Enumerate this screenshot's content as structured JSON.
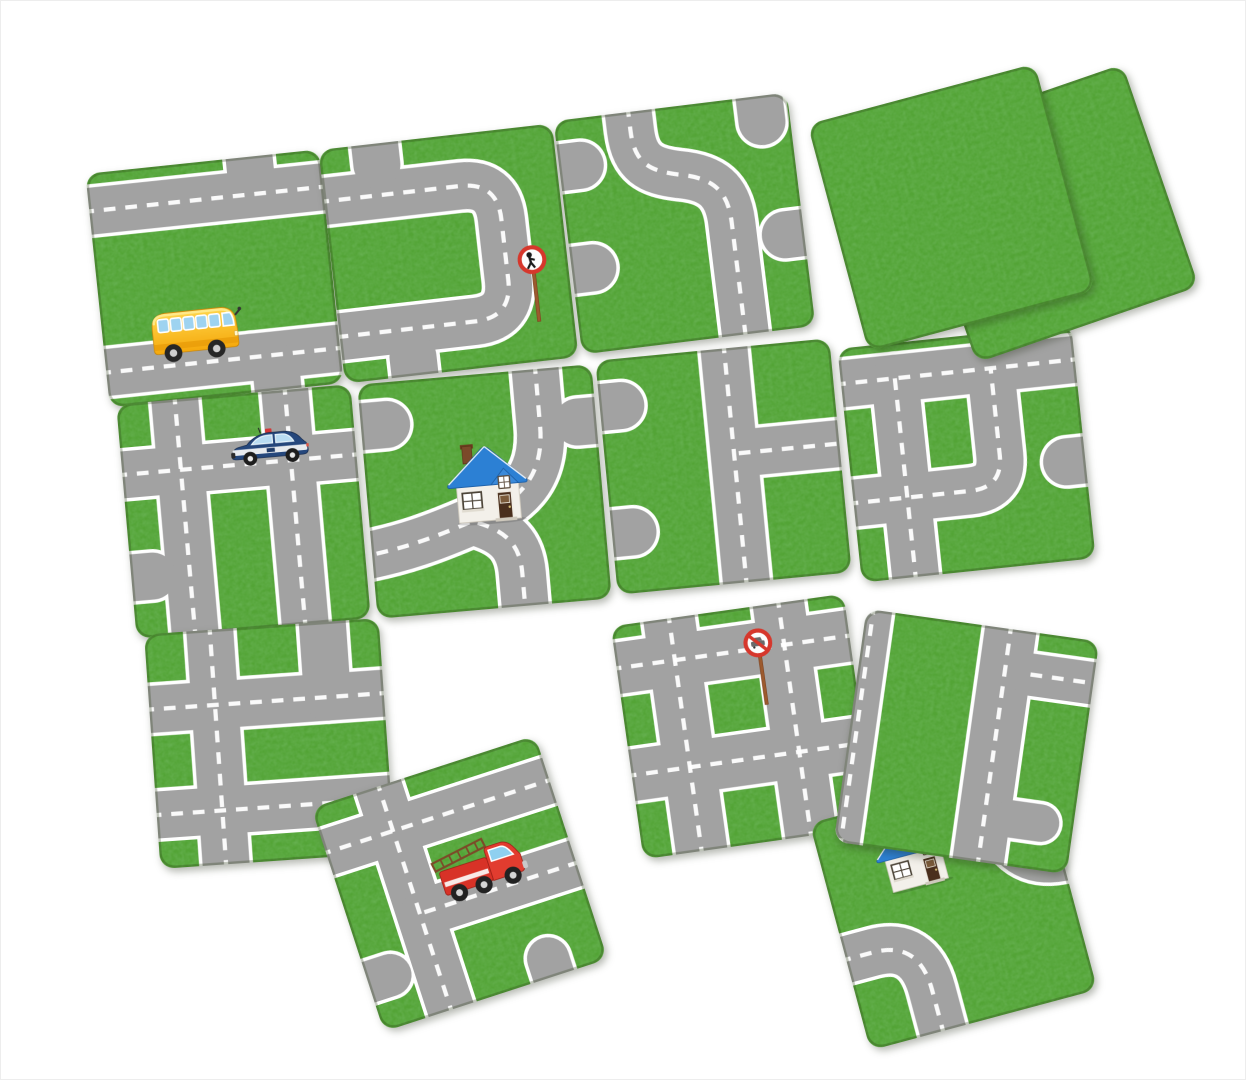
{
  "scene": {
    "width": 1246,
    "height": 1080,
    "background": "#ffffff",
    "description": "road tile matching game pieces laid out on white surface"
  },
  "palette": {
    "grass": "#53a436",
    "grass_dark": "#2e7d1e",
    "road": "#a2a2a2",
    "road_edge": "#ffffff",
    "dash": "#ffffff",
    "tile_border": "rgba(35,55,15,0.28)",
    "sign_red": "#d6372c",
    "pole_brown": "#9c5a2e",
    "bus_yellow": "#f5a90c",
    "truck_red": "#d83227",
    "police_navy": "#25477c",
    "roof_blue": "#2c80d4"
  },
  "tiles": [
    {
      "id": "t1",
      "name": "road-tile-bus",
      "cx": 213,
      "cy": 277,
      "size": 235,
      "rot": -6,
      "z": 1,
      "roads": [
        {
          "d": "M-3,16 H103",
          "w": 20,
          "dash": true
        },
        {
          "d": "M-3,85 H103",
          "w": 20,
          "dash": true
        },
        {
          "d": "M62,85 Q72,85 72,95 V103",
          "w": 20,
          "dash": false
        },
        {
          "d": "M70,-3 V9",
          "w": 20,
          "dash": false
        }
      ],
      "sprites": [
        {
          "icon": "school-bus",
          "x": 18,
          "y": 56,
          "w": 42,
          "h": 29
        }
      ]
    },
    {
      "id": "t2",
      "name": "road-tile-loop-sign",
      "cx": 447,
      "cy": 252,
      "size": 235,
      "rot": -6.5,
      "z": 2,
      "roads": [
        {
          "d": "M-3,22 H58 Q74,22 74,38 V64 Q74,80 58,80 H-3",
          "w": 20,
          "dash": true
        },
        {
          "d": "M24,-3 V9",
          "w": 20,
          "dash": false
        },
        {
          "d": "M30,103 V92",
          "w": 20,
          "dash": false
        }
      ],
      "sprites": [
        {
          "icon": "no-pedestrians-sign",
          "x": 78,
          "y": 50,
          "w": 14,
          "h": 35
        }
      ]
    },
    {
      "id": "t3",
      "name": "road-tile-s-curve",
      "cx": 683,
      "cy": 222,
      "size": 235,
      "rot": -7,
      "z": 3,
      "roads": [
        {
          "d": "M32,-3 V8 C32,22 38,26 50,29 C64,32 70,38 70,52 V103",
          "w": 20,
          "dash": true
        },
        {
          "d": "M88,-3 V11",
          "w": 20,
          "dash": false
        },
        {
          "d": "M103,60 H92",
          "w": 20,
          "dash": false
        },
        {
          "d": "M-3,20 H9",
          "w": 20,
          "dash": false
        },
        {
          "d": "M-3,64 H9",
          "w": 20,
          "dash": false
        }
      ],
      "sprites": []
    },
    {
      "id": "t4",
      "name": "road-tile-police-crossroads",
      "cx": 242,
      "cy": 510,
      "size": 235,
      "rot": -5,
      "z": 4,
      "roads": [
        {
          "d": "M-3,30 H103",
          "w": 20,
          "dash": true
        },
        {
          "d": "M25,-3 V103",
          "w": 20,
          "dash": true
        },
        {
          "d": "M72,-3 V103",
          "w": 20,
          "dash": true
        },
        {
          "d": "M-3,74 H9",
          "w": 20,
          "dash": false
        }
      ],
      "sprites": [
        {
          "icon": "police-car",
          "x": 46,
          "y": 13,
          "w": 35,
          "h": 18
        }
      ]
    },
    {
      "id": "t5",
      "name": "road-tile-house",
      "cx": 483,
      "cy": 490,
      "size": 235,
      "rot": -5,
      "z": 5,
      "roads": [
        {
          "d": "M76,-3 V24 C76,48 62,56 44,62 C26,68 14,71 -3,73",
          "w": 20,
          "dash": true
        },
        {
          "d": "M46,63 C58,68 63,74 63,86 V103",
          "w": 20,
          "dash": true
        },
        {
          "d": "M-3,18 H11",
          "w": 20,
          "dash": false
        },
        {
          "d": "M103,24 H92",
          "w": 20,
          "dash": false
        }
      ],
      "sprites": [
        {
          "icon": "house",
          "x": 33,
          "y": 28,
          "w": 37,
          "h": 36
        }
      ]
    },
    {
      "id": "t6",
      "name": "road-tile-t-junction",
      "cx": 722,
      "cy": 465,
      "size": 235,
      "rot": -5.5,
      "z": 6,
      "roads": [
        {
          "d": "M55,-3 V103",
          "w": 20,
          "dash": true
        },
        {
          "d": "M57,45 H103",
          "w": 20,
          "dash": true
        },
        {
          "d": "M-3,20 H9",
          "w": 20,
          "dash": false
        },
        {
          "d": "M-3,74 H9",
          "w": 20,
          "dash": false
        }
      ],
      "sprites": []
    },
    {
      "id": "t7",
      "name": "road-tile-curve-junction",
      "cx": 965,
      "cy": 452,
      "size": 235,
      "rot": -6,
      "z": 7,
      "roads": [
        {
          "d": "M-3,15 H103",
          "w": 20,
          "dash": true
        },
        {
          "d": "M23,15 V103",
          "w": 20,
          "dash": true
        },
        {
          "d": "M-3,66 H50 Q64,66 64,52 V15",
          "w": 20,
          "dash": true
        },
        {
          "d": "M103,58 H92",
          "w": 20,
          "dash": false
        }
      ],
      "sprites": []
    },
    {
      "id": "p2",
      "name": "grass-tile-back",
      "cx": 1048,
      "cy": 212,
      "size": 235,
      "rot": -19,
      "z": 8,
      "roads": [],
      "sprites": []
    },
    {
      "id": "p1",
      "name": "grass-tile-front",
      "cx": 950,
      "cy": 206,
      "size": 235,
      "rot": -15,
      "z": 9,
      "roads": [],
      "sprites": []
    },
    {
      "id": "t8",
      "name": "road-tile-grid-crossroads",
      "cx": 268,
      "cy": 742,
      "size": 235,
      "rot": -4,
      "z": 10,
      "roads": [
        {
          "d": "M-3,32 H103",
          "w": 20,
          "dash": true
        },
        {
          "d": "M-3,77 H103",
          "w": 20,
          "dash": true
        },
        {
          "d": "M28,-3 V103",
          "w": 20,
          "dash": true
        },
        {
          "d": "M76,-3 V32",
          "w": 20,
          "dash": false
        }
      ],
      "sprites": []
    },
    {
      "id": "t9",
      "name": "road-tile-sign-crossroads",
      "cx": 742,
      "cy": 725,
      "size": 235,
      "rot": -8,
      "z": 11,
      "roads": [
        {
          "d": "M-3,18 H103",
          "w": 22,
          "dash": true
        },
        {
          "d": "M-3,64 H103",
          "w": 22,
          "dash": true
        },
        {
          "d": "M25,-3 V103",
          "w": 22,
          "dash": true
        },
        {
          "d": "M72,-3 V103",
          "w": 22,
          "dash": true
        }
      ],
      "sprites": [
        {
          "icon": "no-cars-sign",
          "x": 54,
          "y": 9,
          "w": 14,
          "h": 35
        }
      ]
    },
    {
      "id": "t12",
      "name": "road-tile-house-corner",
      "cx": 952,
      "cy": 905,
      "size": 235,
      "rot": -15,
      "z": 12,
      "roads": [
        {
          "d": "M-3,60 H12 Q32,60 32,82 V103",
          "w": 20,
          "dash": true
        },
        {
          "d": "M78,-3 V14 Q78,42 103,42",
          "w": 20,
          "dash": true
        }
      ],
      "sprites": [
        {
          "icon": "house",
          "x": 22,
          "y": 6,
          "w": 34,
          "h": 33
        }
      ]
    },
    {
      "id": "t10",
      "name": "road-tile-vertical-junction",
      "cx": 965,
      "cy": 740,
      "size": 235,
      "rot": 8,
      "z": 13,
      "roads": [
        {
          "d": "M62,-3 V103",
          "w": 22,
          "dash": true
        },
        {
          "d": "M73,18 H103",
          "w": 18,
          "dash": true
        },
        {
          "d": "M3,-3 V103",
          "w": 16,
          "dash": true
        },
        {
          "d": "M73,80 H86",
          "w": 16,
          "dash": false
        }
      ],
      "sprites": []
    },
    {
      "id": "t11",
      "name": "road-tile-fire-truck",
      "cx": 458,
      "cy": 882,
      "size": 235,
      "rot": -18,
      "z": 14,
      "roads": [
        {
          "d": "M30,-3 V103",
          "w": 20,
          "dash": true
        },
        {
          "d": "M-3,20 H103",
          "w": 20,
          "dash": true
        },
        {
          "d": "M32,57 H103",
          "w": 20,
          "dash": true
        },
        {
          "d": "M-3,78 H10",
          "w": 18,
          "dash": false
        },
        {
          "d": "M76,103 V92",
          "w": 18,
          "dash": false
        }
      ],
      "sprites": [
        {
          "icon": "fire-truck",
          "x": 40,
          "y": 33,
          "w": 42,
          "h": 26
        }
      ]
    }
  ]
}
